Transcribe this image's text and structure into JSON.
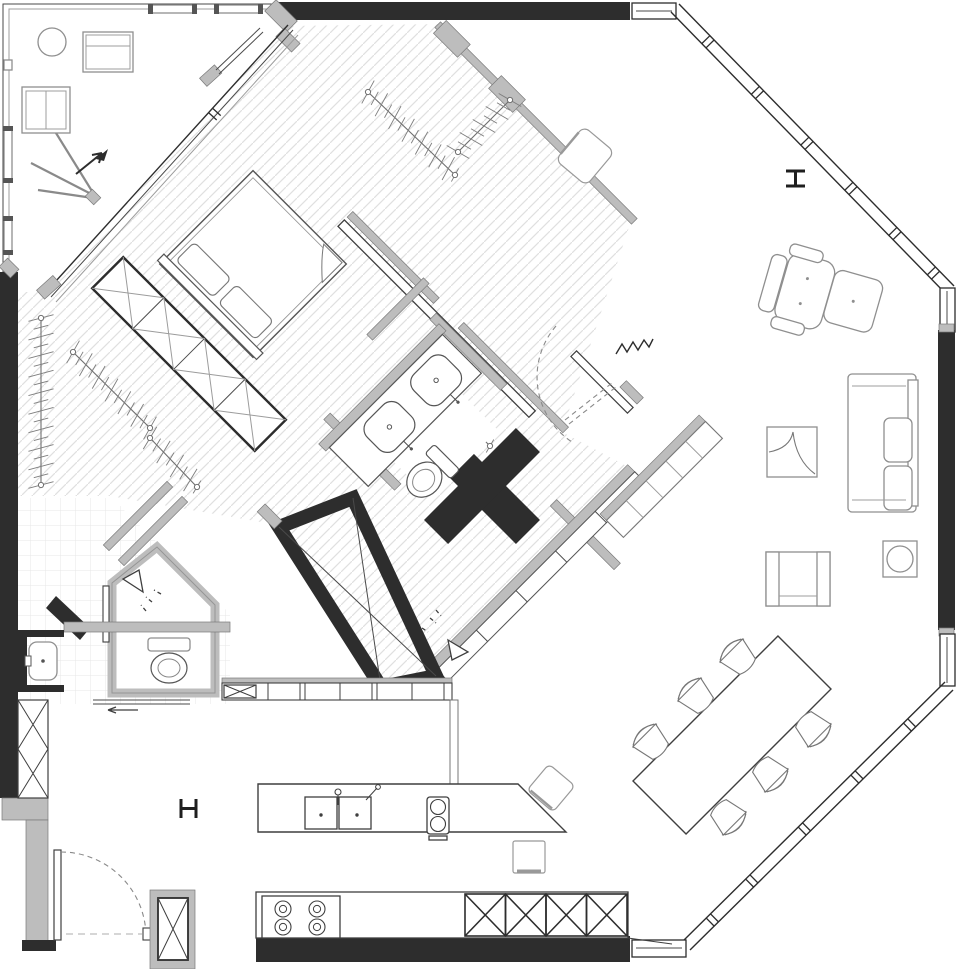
{
  "title": "Apartment floor plan",
  "palette": {
    "background": "#ffffff",
    "wall_black": "#2d2d2d",
    "wall_grey": "#bdbdbd",
    "line_dark": "#2d2d2d",
    "line_mid": "#6f6f6f",
    "line_light": "#9a9a9a",
    "hatch": "#dfdfdf",
    "tile": "#ebebeb"
  },
  "rooms": {
    "bedroom": "bedroom",
    "walk_in_closet": "walk-in closet",
    "wardrobe": "wardrobe wall",
    "bathroom": "bathroom",
    "wc": "guest WC",
    "utility": "utility room",
    "entry_hall": "entry hall",
    "living_room": "living room",
    "dining_area": "dining area",
    "kitchen": "kitchen",
    "terrace": "terrace"
  },
  "furniture": {
    "bed": "double bed",
    "bed_wardrobe": "wardrobe with X-fronts",
    "bench": "low bench shelf",
    "sofa": "two-seat sofa",
    "armchair": "armchair",
    "recliner": "recliner chair",
    "ottoman": "ottoman",
    "tv_console": "tv console",
    "side_table": "side table",
    "decor_square": "rug / cabinet",
    "dining_table": "dining table",
    "dining_chair": "dining chair",
    "hall_stool": "stool",
    "island": "kitchen island",
    "island_stool": "island stool",
    "round_table": "terrace round table",
    "loveseat": "terrace loveseat",
    "terrace_chair": "terrace armchair"
  },
  "fixtures": {
    "basin": "washbasin",
    "toilet": "toilet",
    "sink_double": "double kitchen sink",
    "hob2": "2-burner hob",
    "stove4": "4-burner cooktop",
    "glass_box": "black glass box frame",
    "column_cross": "cross-shaped structural column"
  },
  "symbols": {
    "steel_column_marker": "I-beam column section",
    "door_swing": "door swing arc",
    "clothes_rail": "clothes hanging rail",
    "entry_arrow": "direction arrow",
    "spring": "pocket-door spring"
  },
  "counts": {
    "dining_chairs": 6,
    "cooktop_burners": 4,
    "island_hob_burners": 2,
    "bathroom_basins": 2,
    "toilets": 2,
    "steel_column_markers": 2,
    "wardrobe_x_cells": 4,
    "base_cabinet_x_cells": 4
  }
}
